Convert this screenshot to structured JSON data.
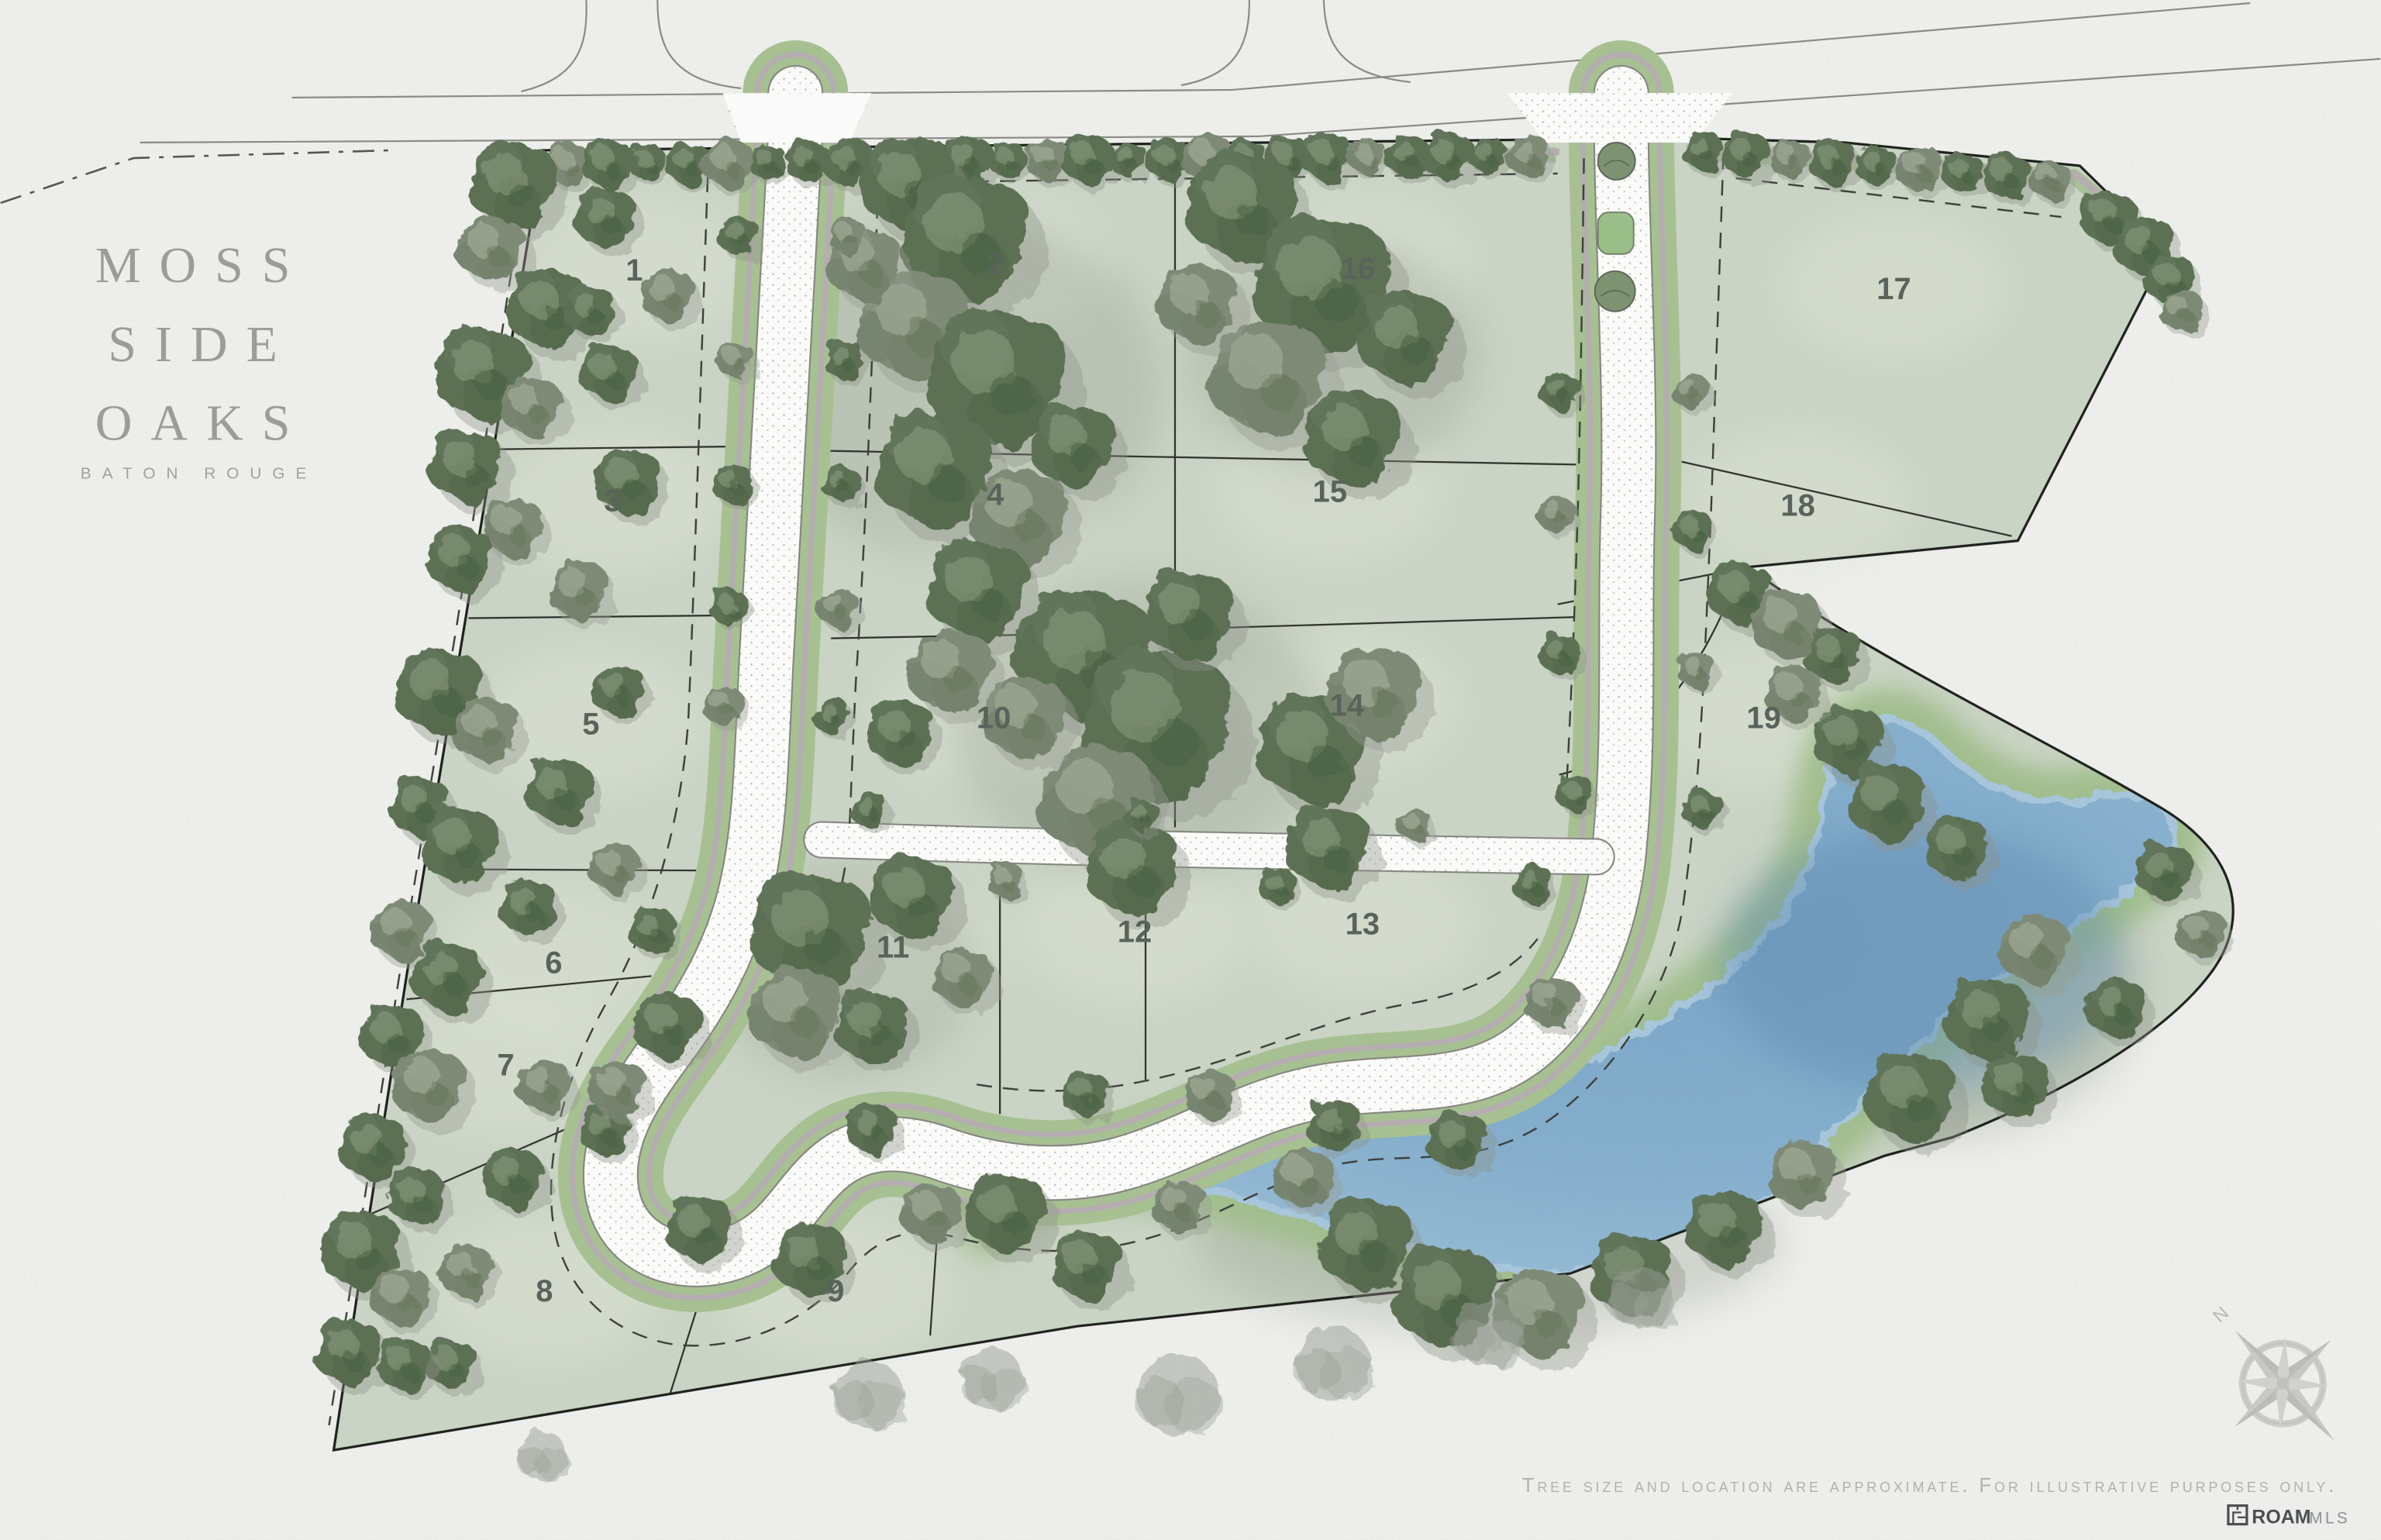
{
  "title": {
    "lines": [
      "MOSS",
      "SIDE",
      "OAKS"
    ],
    "subtitle": "BATON ROUGE"
  },
  "lots": [
    {
      "number": "1"
    },
    {
      "number": "2"
    },
    {
      "number": "3"
    },
    {
      "number": "4"
    },
    {
      "number": "5"
    },
    {
      "number": "6"
    },
    {
      "number": "7"
    },
    {
      "number": "8"
    },
    {
      "number": "9"
    },
    {
      "number": "10"
    },
    {
      "number": "11"
    },
    {
      "number": "12"
    },
    {
      "number": "13"
    },
    {
      "number": "14"
    },
    {
      "number": "15"
    },
    {
      "number": "16"
    },
    {
      "number": "17"
    },
    {
      "number": "18"
    },
    {
      "number": "19"
    }
  ],
  "compass": {
    "north_label": "N"
  },
  "footer": {
    "disclaimer": "Tree size and location are approximate. For illustrative purposes only.",
    "brand": "ROAM",
    "brand_suffix": "MLS"
  },
  "colors": {
    "paper": "#f1f2ef",
    "lot_fill": "#ccd6c7",
    "tree_green": "#5b6f53",
    "road_white": "#fdfdfc",
    "road_green_strip": "#a8c293",
    "sidewalk_gray": "#b6aeb2",
    "pond_blue": "#83add0",
    "pond_buffer": "#a2bf8e",
    "line_dark": "#1c1e1a",
    "title_gray": "#9d9d97",
    "label_gray": "#59625a",
    "muted_text": "#b2b2ae"
  }
}
